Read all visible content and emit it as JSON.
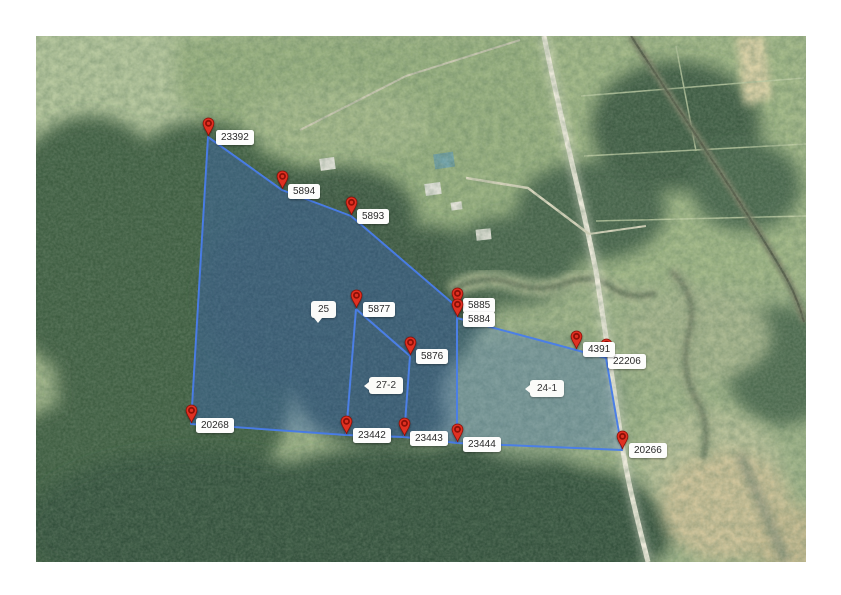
{
  "map": {
    "width": 770,
    "height": 526,
    "offset_x": 36,
    "offset_y": 36,
    "colors": {
      "parcel_fill": "rgba(64,120,230,0.22)",
      "parcel_fill_dark": "rgba(35,80,195,0.13)",
      "parcel_stroke": "#4b7fe6",
      "pin_fill": "#e03122",
      "pin_ring": "#8d1007",
      "label_bg": "#fdfdfc",
      "label_text": "#2a2a2a"
    },
    "markers": [
      {
        "id": "23392",
        "label": "23392",
        "x": 172,
        "y": 101,
        "dx": 8,
        "dy": -7
      },
      {
        "id": "5894",
        "label": "5894",
        "x": 246,
        "y": 154,
        "dx": 6,
        "dy": -6
      },
      {
        "id": "5893",
        "label": "5893",
        "x": 315,
        "y": 180,
        "dx": 6,
        "dy": -7
      },
      {
        "id": "5877",
        "label": "5877",
        "x": 320,
        "y": 273,
        "dx": 7,
        "dy": -7
      },
      {
        "id": "5885",
        "label": "5885",
        "x": 421,
        "y": 271,
        "dx": 6,
        "dy": -9
      },
      {
        "id": "5884",
        "label": "5884",
        "x": 421,
        "y": 282,
        "dx": 6,
        "dy": -6
      },
      {
        "id": "5876",
        "label": "5876",
        "x": 374,
        "y": 320,
        "dx": 6,
        "dy": -7
      },
      {
        "id": "22206",
        "label": "22206",
        "x": 570,
        "y": 322,
        "dx": 2,
        "dy": -4
      },
      {
        "id": "4391",
        "label": "4391",
        "x": 540,
        "y": 314,
        "dx": 7,
        "dy": -8
      },
      {
        "id": "20268",
        "label": "20268",
        "x": 155,
        "y": 388,
        "dx": 5,
        "dy": -6
      },
      {
        "id": "23442",
        "label": "23442",
        "x": 310,
        "y": 399,
        "dx": 7,
        "dy": -7
      },
      {
        "id": "23443",
        "label": "23443",
        "x": 368,
        "y": 401,
        "dx": 6,
        "dy": -6
      },
      {
        "id": "23444",
        "label": "23444",
        "x": 421,
        "y": 407,
        "dx": 6,
        "dy": -6
      },
      {
        "id": "20266",
        "label": "20266",
        "x": 586,
        "y": 414,
        "dx": 7,
        "dy": -7
      }
    ],
    "parcel_labels": [
      {
        "id": "25",
        "label": "25",
        "x": 275,
        "y": 265,
        "tail": "bottom"
      },
      {
        "id": "27-2",
        "label": "27-2",
        "x": 333,
        "y": 341,
        "tail": "left"
      },
      {
        "id": "24-1",
        "label": "24-1",
        "x": 494,
        "y": 344,
        "tail": "left"
      }
    ],
    "boundary": [
      "23392",
      "5894",
      "5893",
      "5885",
      "5884",
      "4391",
      "22206",
      "20266",
      "23444",
      "23443",
      "23442",
      "20268"
    ],
    "inner_lines": [
      [
        "5877",
        "23442"
      ],
      [
        "5877",
        "5876"
      ],
      [
        "5876",
        "23443"
      ],
      [
        "5884",
        "23444"
      ]
    ],
    "dark_tint_region": [
      "23392",
      "5894",
      "5893",
      "5885",
      "5884",
      "23444",
      "23443",
      "23442",
      "20268"
    ]
  }
}
